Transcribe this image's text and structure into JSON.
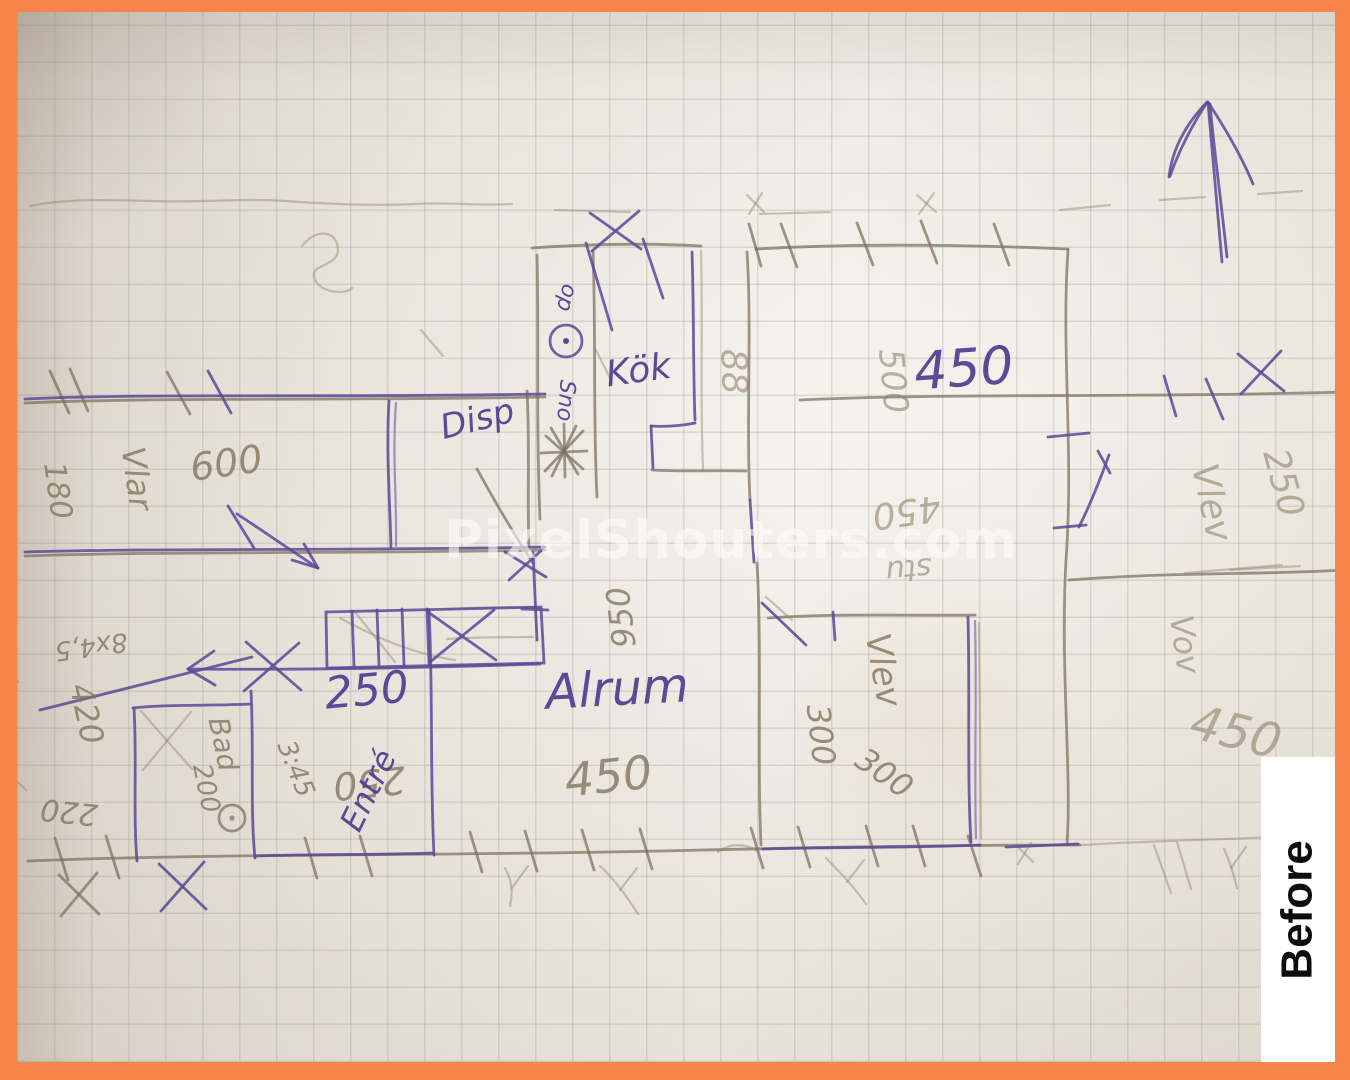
{
  "badge": {
    "text": "Before"
  },
  "watermark": {
    "text": "PixelShouters.com"
  },
  "palette": {
    "frame_orange": "#F6854C",
    "pen_purple": "#5A4898",
    "pencil_gray": "#7B6F5D"
  },
  "labels": {
    "kok": "Kök",
    "kok_dim_88": "88",
    "chimney_op": "op",
    "chimney_sno": "Sno",
    "disp": "Disp",
    "top_500": "500",
    "big_450": "450",
    "mid_450_flipped": "450",
    "mid_stu": "stu",
    "dim_950": "950",
    "alrum": "Alrum",
    "alrum_450": "450",
    "entre": "Entré",
    "entre_250": "250",
    "entre_250_flipped": "250",
    "bad": "Bad",
    "bad_200": "200",
    "bad_note": "3:45",
    "left_8x45": "8x4,5",
    "left_420": "420",
    "left_220": "220",
    "left_180": "180",
    "left_room": "Vlar",
    "left_600": "600",
    "vlev_room": "Vlev",
    "vlev_300_a": "300",
    "vlev_300_b": "300",
    "right_vlev": "Vlev",
    "right_250": "250",
    "right_vov": "Vov",
    "right_450": "450"
  }
}
